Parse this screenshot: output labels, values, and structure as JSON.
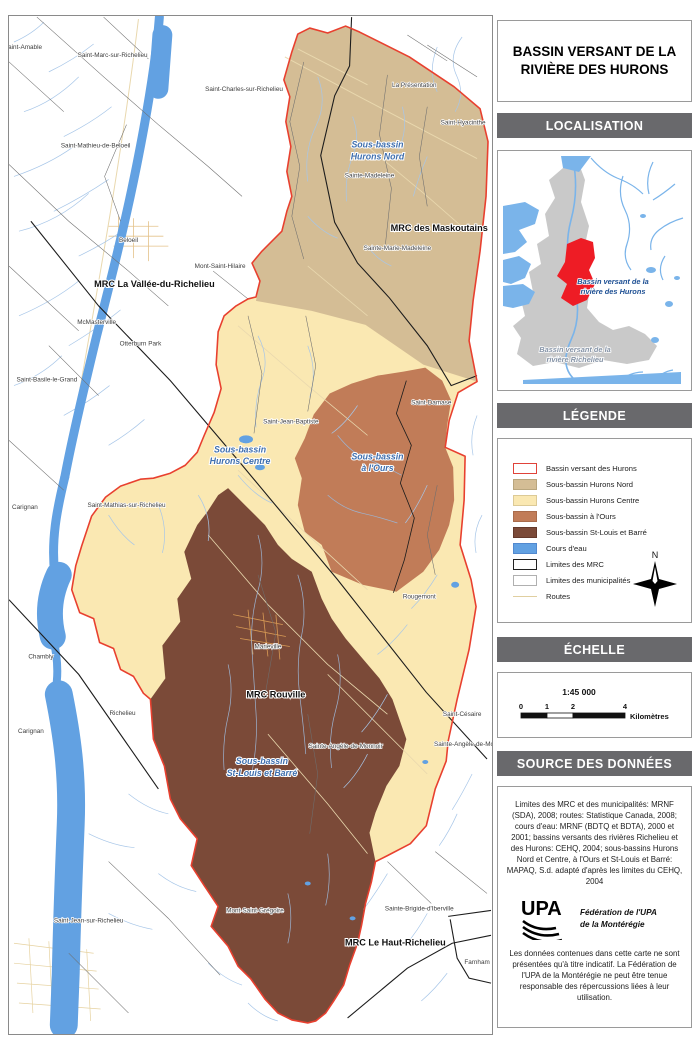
{
  "title": "BASSIN VERSANT DE LA RIVIÈRE DES HURONS",
  "sections": {
    "localisation": "LOCALISATION",
    "legende": "LÉGENDE",
    "echelle": "ÉCHELLE",
    "source": "SOURCE DES DONNÉES"
  },
  "map": {
    "towns": [
      {
        "t": "Saint-Amable",
        "x": 14,
        "y": 32,
        "a": "start"
      },
      {
        "t": "Saint-Marc-sur-Richelieu",
        "x": 104,
        "y": 40
      },
      {
        "t": "Saint-Charles-sur-Richelieu",
        "x": 236,
        "y": 74
      },
      {
        "t": "Saint-Mathieu-de-Beloeil",
        "x": 87,
        "y": 131
      },
      {
        "t": "Beloeil",
        "x": 120,
        "y": 226
      },
      {
        "t": "Mont-Saint-Hilaire",
        "x": 212,
        "y": 252
      },
      {
        "t": "McMasterville",
        "x": 88,
        "y": 308
      },
      {
        "t": "Otterburn Park",
        "x": 132,
        "y": 330
      },
      {
        "t": "Saint-Basile-le-Grand",
        "x": 38,
        "y": 366,
        "a": "start"
      },
      {
        "t": "Carignan",
        "x": 16,
        "y": 494,
        "a": "start"
      },
      {
        "t": "Saint-Mathias-sur-Richelieu",
        "x": 118,
        "y": 492
      },
      {
        "t": "Chambly",
        "x": 32,
        "y": 644
      },
      {
        "t": "Richelieu",
        "x": 114,
        "y": 701
      },
      {
        "t": "Carignan",
        "x": 22,
        "y": 719,
        "a": "start"
      },
      {
        "t": "Saint-Jean-sur-Richelieu",
        "x": 80,
        "y": 909
      },
      {
        "t": "Mont-Saint-Grégoire",
        "x": 247,
        "y": 899
      },
      {
        "t": "Sainte-Brigide-d'Iberville",
        "x": 412,
        "y": 897
      },
      {
        "t": "Farnham",
        "x": 470,
        "y": 951
      },
      {
        "t": "Saint-Césaire",
        "x": 455,
        "y": 702
      },
      {
        "t": "Sainte-Angèle-de-Monnoir",
        "x": 338,
        "y": 734
      },
      {
        "t": "Sainte-Angèle-de-Monnoir",
        "x": 464,
        "y": 732
      },
      {
        "t": "Rougemont",
        "x": 412,
        "y": 584
      },
      {
        "t": "Saint-Damase",
        "x": 424,
        "y": 389
      },
      {
        "t": "Saint-Hyacinthe",
        "x": 456,
        "y": 108
      },
      {
        "t": "La Présentation",
        "x": 407,
        "y": 70
      },
      {
        "t": "Sainte-Madeleine",
        "x": 362,
        "y": 161
      },
      {
        "t": "Sainte-Marie-Madeleine",
        "x": 390,
        "y": 234
      },
      {
        "t": "Saint-Jean-Baptiste",
        "x": 283,
        "y": 408
      },
      {
        "t": "Marieville",
        "x": 260,
        "y": 634
      }
    ],
    "mrc": [
      {
        "t": "MRC La Vallée-du-Richelieu",
        "x": 146,
        "y": 271
      },
      {
        "t": "MRC des Maskoutains",
        "x": 432,
        "y": 215
      },
      {
        "t": "MRC Rouville",
        "x": 268,
        "y": 683
      },
      {
        "t": "MRC Le Haut-Richelieu",
        "x": 388,
        "y": 932
      }
    ],
    "subbasins": [
      {
        "lines": [
          "Sous-bassin",
          "Hurons Nord"
        ],
        "x": 370,
        "y": 131
      },
      {
        "lines": [
          "Sous-bassin",
          "Hurons Centre"
        ],
        "x": 232,
        "y": 437
      },
      {
        "lines": [
          "Sous-bassin",
          "à l'Ours"
        ],
        "x": 370,
        "y": 444
      },
      {
        "lines": [
          "Sous-bassin",
          "St-Louis et Barré"
        ],
        "x": 254,
        "y": 750
      }
    ]
  },
  "inset": {
    "labels": [
      {
        "lines": [
          "Bassin versant de la",
          "rivière des Hurons"
        ],
        "x": 110,
        "y": 128,
        "cls": "ins-hur"
      },
      {
        "lines": [
          "Bassin versant de la",
          "rivière Richelieu"
        ],
        "x": 72,
        "y": 196,
        "cls": "ins-ric"
      }
    ]
  },
  "legend": {
    "items": [
      {
        "label": "Bassin versant des Hurons",
        "fill": "#ffffff",
        "stroke": "#e0433a",
        "sw": 1.6
      },
      {
        "label": "Sous-bassin Hurons Nord",
        "fill": "#d4bd95",
        "stroke": "#b9a67e",
        "sw": 0.8
      },
      {
        "label": "Sous-bassin Hurons Centre",
        "fill": "#fae8b2",
        "stroke": "#dcca96",
        "sw": 0.8
      },
      {
        "label": "Sous-bassin à l'Ours",
        "fill": "#c17c58",
        "stroke": "#a96b4b",
        "sw": 0.8
      },
      {
        "label": "Sous-bassin St-Louis et Barré",
        "fill": "#7b4a38",
        "stroke": "#64392b",
        "sw": 0.8
      },
      {
        "label": "Cours d'eau",
        "fill": "#62a1e2",
        "stroke": "#5289cf",
        "sw": 0.8
      },
      {
        "label": "Limites des MRC",
        "fill": "#ffffff",
        "stroke": "#222222",
        "sw": 1.2
      },
      {
        "label": "Limites des municipalités",
        "fill": "#ffffff",
        "stroke": "#b0b0b0",
        "sw": 1
      },
      {
        "label": "Routes",
        "type": "line"
      }
    ],
    "compass_label": "N"
  },
  "scale": {
    "ratio": "1:45 000",
    "ticks": [
      0,
      1,
      2,
      4
    ],
    "unit": "Kilomètres"
  },
  "source_text": "Limites des MRC et des municipalités: MRNF (SDA), 2008; routes: Statistique Canada, 2008; cours d'eau: MRNF (BDTQ et BDTA), 2000 et 2001; bassins versants des rivières Richelieu et des Hurons: CEHQ, 2004; sous-bassins Hurons Nord et Centre, à l'Ours et St-Louis et Barré: MAPAQ, S.d. adapté d'après les limites du CEHQ, 2004",
  "upa": {
    "acronym": "UPA",
    "name_line1": "Fédération de l'UPA",
    "name_line2": "de la Montérégie"
  },
  "disclaimer": "Les données contenues dans cette carte ne sont présentées qu'à titre indicatif. La Fédération de l'UPA de la Montérégie ne peut être tenue responsable des répercussions liées à leur utilisation.",
  "colors": {
    "hurons_nord": "#d4bd95",
    "hurons_centre": "#fae8b2",
    "a_l_ours": "#c17c58",
    "st_louis_barre": "#7b4a38",
    "bassin_outline": "#e8402f",
    "water": "#62a1e2",
    "inset_red": "#ee1c25",
    "inset_gray": "#c9c9c9",
    "header_bar": "#69696c"
  }
}
